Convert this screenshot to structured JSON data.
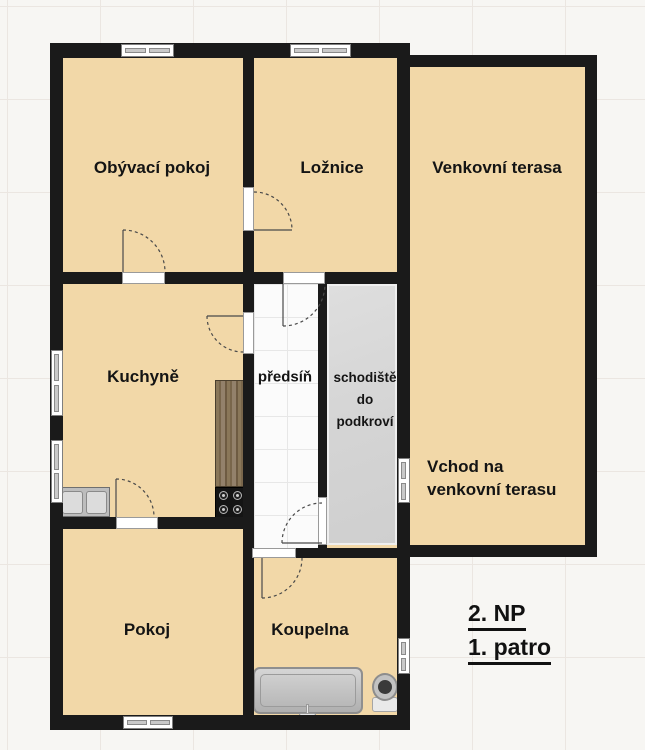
{
  "plan": {
    "type": "floor-plan",
    "language": "cs",
    "colors": {
      "wall": "#1a1a1a",
      "room_fill": "#f2d8a8",
      "hallway_fill": "#fbfbfb",
      "staircase_fill": "#d8d8d8",
      "background": "#f7f6f3"
    },
    "rooms": {
      "living_room": {
        "label": "Obývací pokoj"
      },
      "bedroom": {
        "label": "Ložnice"
      },
      "terrace": {
        "label": "Venkovní terasa"
      },
      "kitchen": {
        "label": "Kuchyně"
      },
      "hallway": {
        "label": "předsíň"
      },
      "staircase": {
        "label": "schodiště\ndo\npodkroví"
      },
      "terrace_entrance": {
        "label": "Vchod na\nvenkovní terasu"
      },
      "room": {
        "label": "Pokoj"
      },
      "bathroom": {
        "label": "Koupelna"
      }
    },
    "floor_labels": {
      "np": "2. NP",
      "patro": "1. patro"
    }
  }
}
